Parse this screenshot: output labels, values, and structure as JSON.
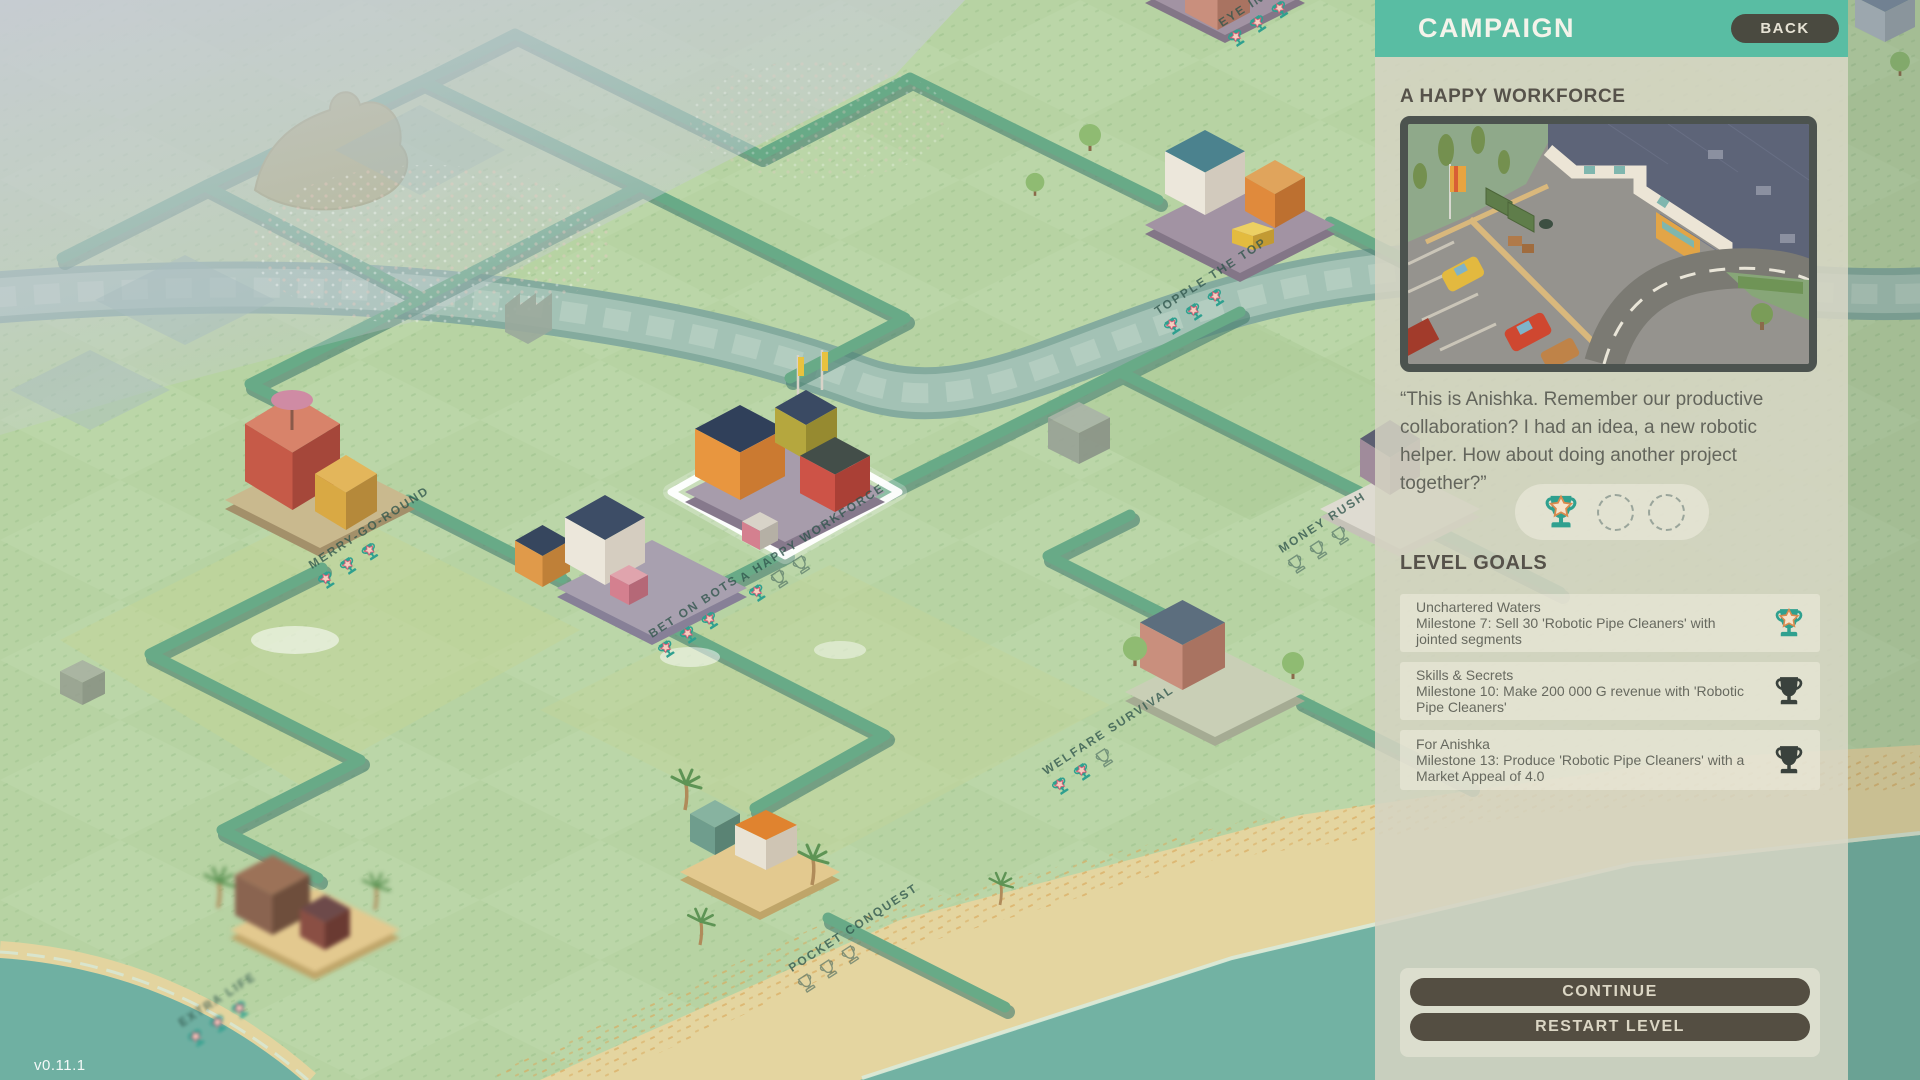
{
  "version": "v0.11.1",
  "panel": {
    "header": {
      "title": "CAMPAIGN",
      "back_label": "BACK"
    },
    "level_title": "A HAPPY WORKFORCE",
    "preview_description": "Isometric factory with parking lot, road and fenced yard",
    "quote": "“This is Anishka. Remember our productive collaboration? I had an idea, a new robotic helper. How about doing another project together?”",
    "trophies": {
      "earned": 1,
      "total": 3
    },
    "goals_heading": "LEVEL GOALS",
    "goals": [
      {
        "title": "Unchartered Waters",
        "description": "Milestone 7: Sell 30 'Robotic Pipe Cleaners' with jointed segments",
        "completed": true
      },
      {
        "title": "Skills & Secrets",
        "description": "Milestone 10: Make 200 000 G revenue with 'Robotic Pipe Cleaners'",
        "completed": false
      },
      {
        "title": "For Anishka",
        "description": "Milestone 13: Produce 'Robotic Pipe Cleaners' with a Market Appeal of 4.0",
        "completed": false
      }
    ],
    "buttons": {
      "continue": "CONTINUE",
      "restart": "RESTART LEVEL"
    }
  },
  "map": {
    "levels": [
      {
        "name": "EYE IN THE SKY",
        "trophies_earned": 3,
        "trophies_total": 3,
        "selected": false
      },
      {
        "name": "TOPPLE THE TOP",
        "trophies_earned": 3,
        "trophies_total": 3,
        "selected": false
      },
      {
        "name": "MERRY-GO-ROUND",
        "trophies_earned": 3,
        "trophies_total": 3,
        "selected": false
      },
      {
        "name": "BET ON BOTS",
        "trophies_earned": 3,
        "trophies_total": 3,
        "selected": false
      },
      {
        "name": "A HAPPY WORKFORCE",
        "trophies_earned": 1,
        "trophies_total": 3,
        "selected": true
      },
      {
        "name": "MONEY RUSH",
        "trophies_earned": 0,
        "trophies_total": 3,
        "selected": false
      },
      {
        "name": "WELFARE SURVIVAL",
        "trophies_earned": 2,
        "trophies_total": 3,
        "selected": false
      },
      {
        "name": "POCKET CONQUEST",
        "trophies_earned": 0,
        "trophies_total": 3,
        "selected": false
      },
      {
        "name": "EXTRA LIFE",
        "trophies_earned": 3,
        "trophies_total": 3,
        "selected": false
      }
    ]
  },
  "colors": {
    "header_teal": "#59bda3",
    "panel_beige": "#d5d3c2",
    "trophy_teal": "#2fa08f",
    "button_brown": "#544e42",
    "road_green": "#68aa87",
    "grass": "#b7d3a3",
    "ocean": "#72b2a3",
    "sand": "#e4d5a0"
  }
}
